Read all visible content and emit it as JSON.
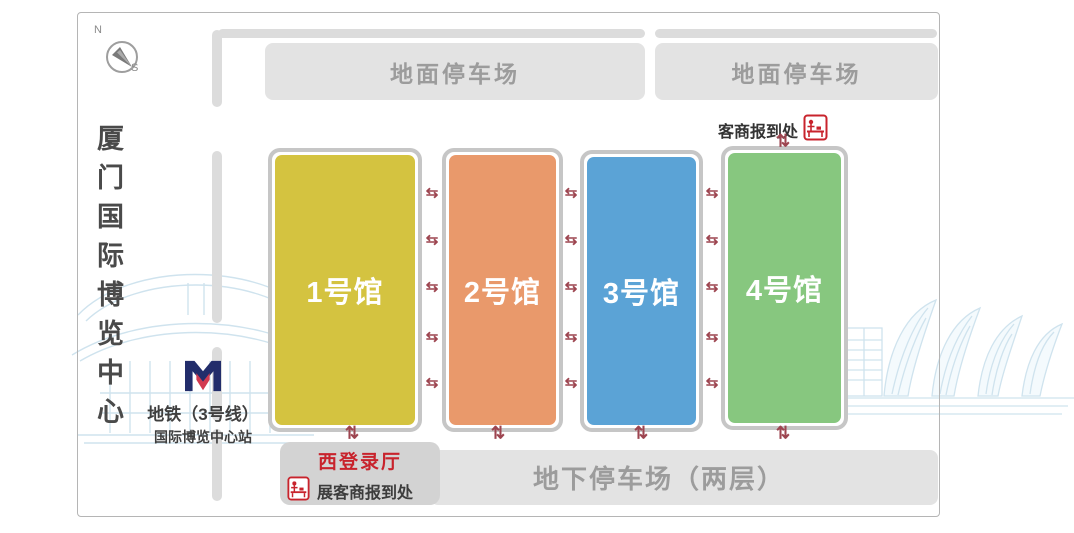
{
  "page": {
    "title": "厦门国际博览中心"
  },
  "compass": {
    "north": "N",
    "south": "S"
  },
  "ground_parking": {
    "left_label": "地面停车场",
    "right_label": "地面停车场"
  },
  "halls": [
    {
      "label": "1号馆",
      "color": "#d4c340"
    },
    {
      "label": "2号馆",
      "color": "#e9996b"
    },
    {
      "label": "3号馆",
      "color": "#5ba3d6"
    },
    {
      "label": "4号馆",
      "color": "#87c77f"
    }
  ],
  "merchant_checkin": {
    "label": "客商报到处"
  },
  "west_hall": {
    "title": "西登录厅",
    "title_color": "#c8232c",
    "checkin_label": "展客商报到处"
  },
  "underground_parking": {
    "label": "地下停车场（两层）"
  },
  "metro": {
    "line_label": "地铁（3号线）",
    "station_label": "国际博览中心站",
    "logo_navy": "#222d6b",
    "logo_red": "#d23a50"
  },
  "arrows": {
    "h_glyph": "⇆",
    "v_glyph": "⇅",
    "color": "#9d4550"
  },
  "icons": {
    "reception_desk_color": "#c8232c"
  }
}
